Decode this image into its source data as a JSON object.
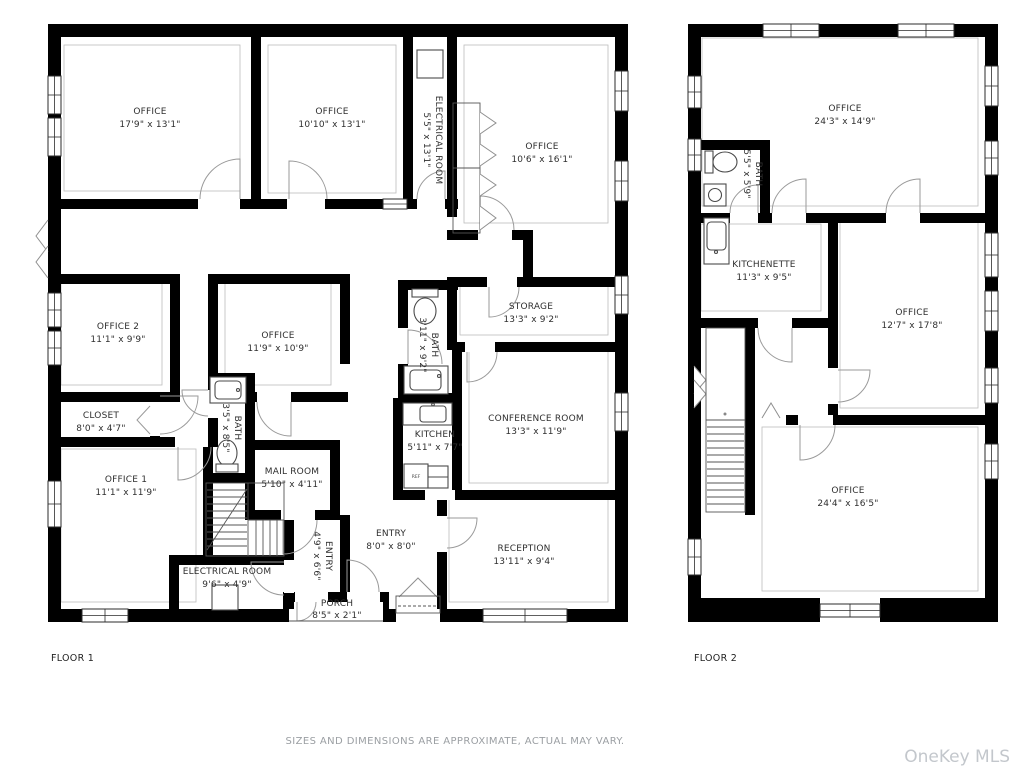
{
  "footer": {
    "disclaimer": "SIZES AND DIMENSIONS ARE APPROXIMATE, ACTUAL MAY VARY.",
    "watermark": "OneKey MLS"
  },
  "floor1": {
    "title": "FLOOR 1",
    "rooms": [
      {
        "id": "office-a",
        "name": "OFFICE",
        "dims": "17'9\" x 13'1\""
      },
      {
        "id": "office-b",
        "name": "OFFICE",
        "dims": "10'10\" x 13'1\""
      },
      {
        "id": "electrical-room-top",
        "name": "ELECTRICAL ROOM",
        "dims": "5'5\" x 13'1\""
      },
      {
        "id": "office-c",
        "name": "OFFICE",
        "dims": "10'6\" x 16'1\""
      },
      {
        "id": "office-2",
        "name": "OFFICE 2",
        "dims": "11'1\" x 9'9\""
      },
      {
        "id": "office-mid",
        "name": "OFFICE",
        "dims": "11'9\" x 10'9\""
      },
      {
        "id": "storage",
        "name": "STORAGE",
        "dims": "13'3\" x 9'2\""
      },
      {
        "id": "bath-upper",
        "name": "BATH",
        "dims": "3'11\" x 9'2\""
      },
      {
        "id": "closet",
        "name": "CLOSET",
        "dims": "8'0\" x 4'7\""
      },
      {
        "id": "bath-lower",
        "name": "BATH",
        "dims": "3'5\" x 8'5\""
      },
      {
        "id": "kitchen",
        "name": "KITCHEN",
        "dims": "5'11\" x 7'7\""
      },
      {
        "id": "conference-room",
        "name": "CONFERENCE ROOM",
        "dims": "13'3\" x 11'9\""
      },
      {
        "id": "office-1",
        "name": "OFFICE 1",
        "dims": "11'1\" x 11'9\""
      },
      {
        "id": "mail-room",
        "name": "MAIL ROOM",
        "dims": "5'10\" x 4'11\""
      },
      {
        "id": "entry-small",
        "name": "ENTRY",
        "dims": "4'9\" x 6'6\""
      },
      {
        "id": "entry-main",
        "name": "ENTRY",
        "dims": "8'0\" x 8'0\""
      },
      {
        "id": "electrical-room-bottom",
        "name": "ELECTRICAL ROOM",
        "dims": "9'6\" x 4'9\""
      },
      {
        "id": "reception",
        "name": "RECEPTION",
        "dims": "13'11\" x 9'4\""
      },
      {
        "id": "porch",
        "name": "PORCH",
        "dims": "8'5\" x 2'1\""
      }
    ],
    "appliances": {
      "refrigerator": "REF"
    }
  },
  "floor2": {
    "title": "FLOOR 2",
    "rooms": [
      {
        "id": "office-top",
        "name": "OFFICE",
        "dims": "24'3\" x 14'9\""
      },
      {
        "id": "bath",
        "name": "BATH",
        "dims": "5'5\" x 5'9\""
      },
      {
        "id": "kitchenette",
        "name": "KITCHENETTE",
        "dims": "11'3\" x 9'5\""
      },
      {
        "id": "office-right",
        "name": "OFFICE",
        "dims": "12'7\" x 17'8\""
      },
      {
        "id": "office-bottom",
        "name": "OFFICE",
        "dims": "24'4\" x 16'5\""
      }
    ]
  },
  "colors": {
    "wall": "#000000",
    "label_text": "#2f2f2f",
    "thin_line": "#bcbcbc",
    "symbol_line": "#9a9a9a",
    "fixture_line": "#4a4a4a",
    "muted_text": "#9b9fa3",
    "watermark_text": "#c3c7cc"
  }
}
